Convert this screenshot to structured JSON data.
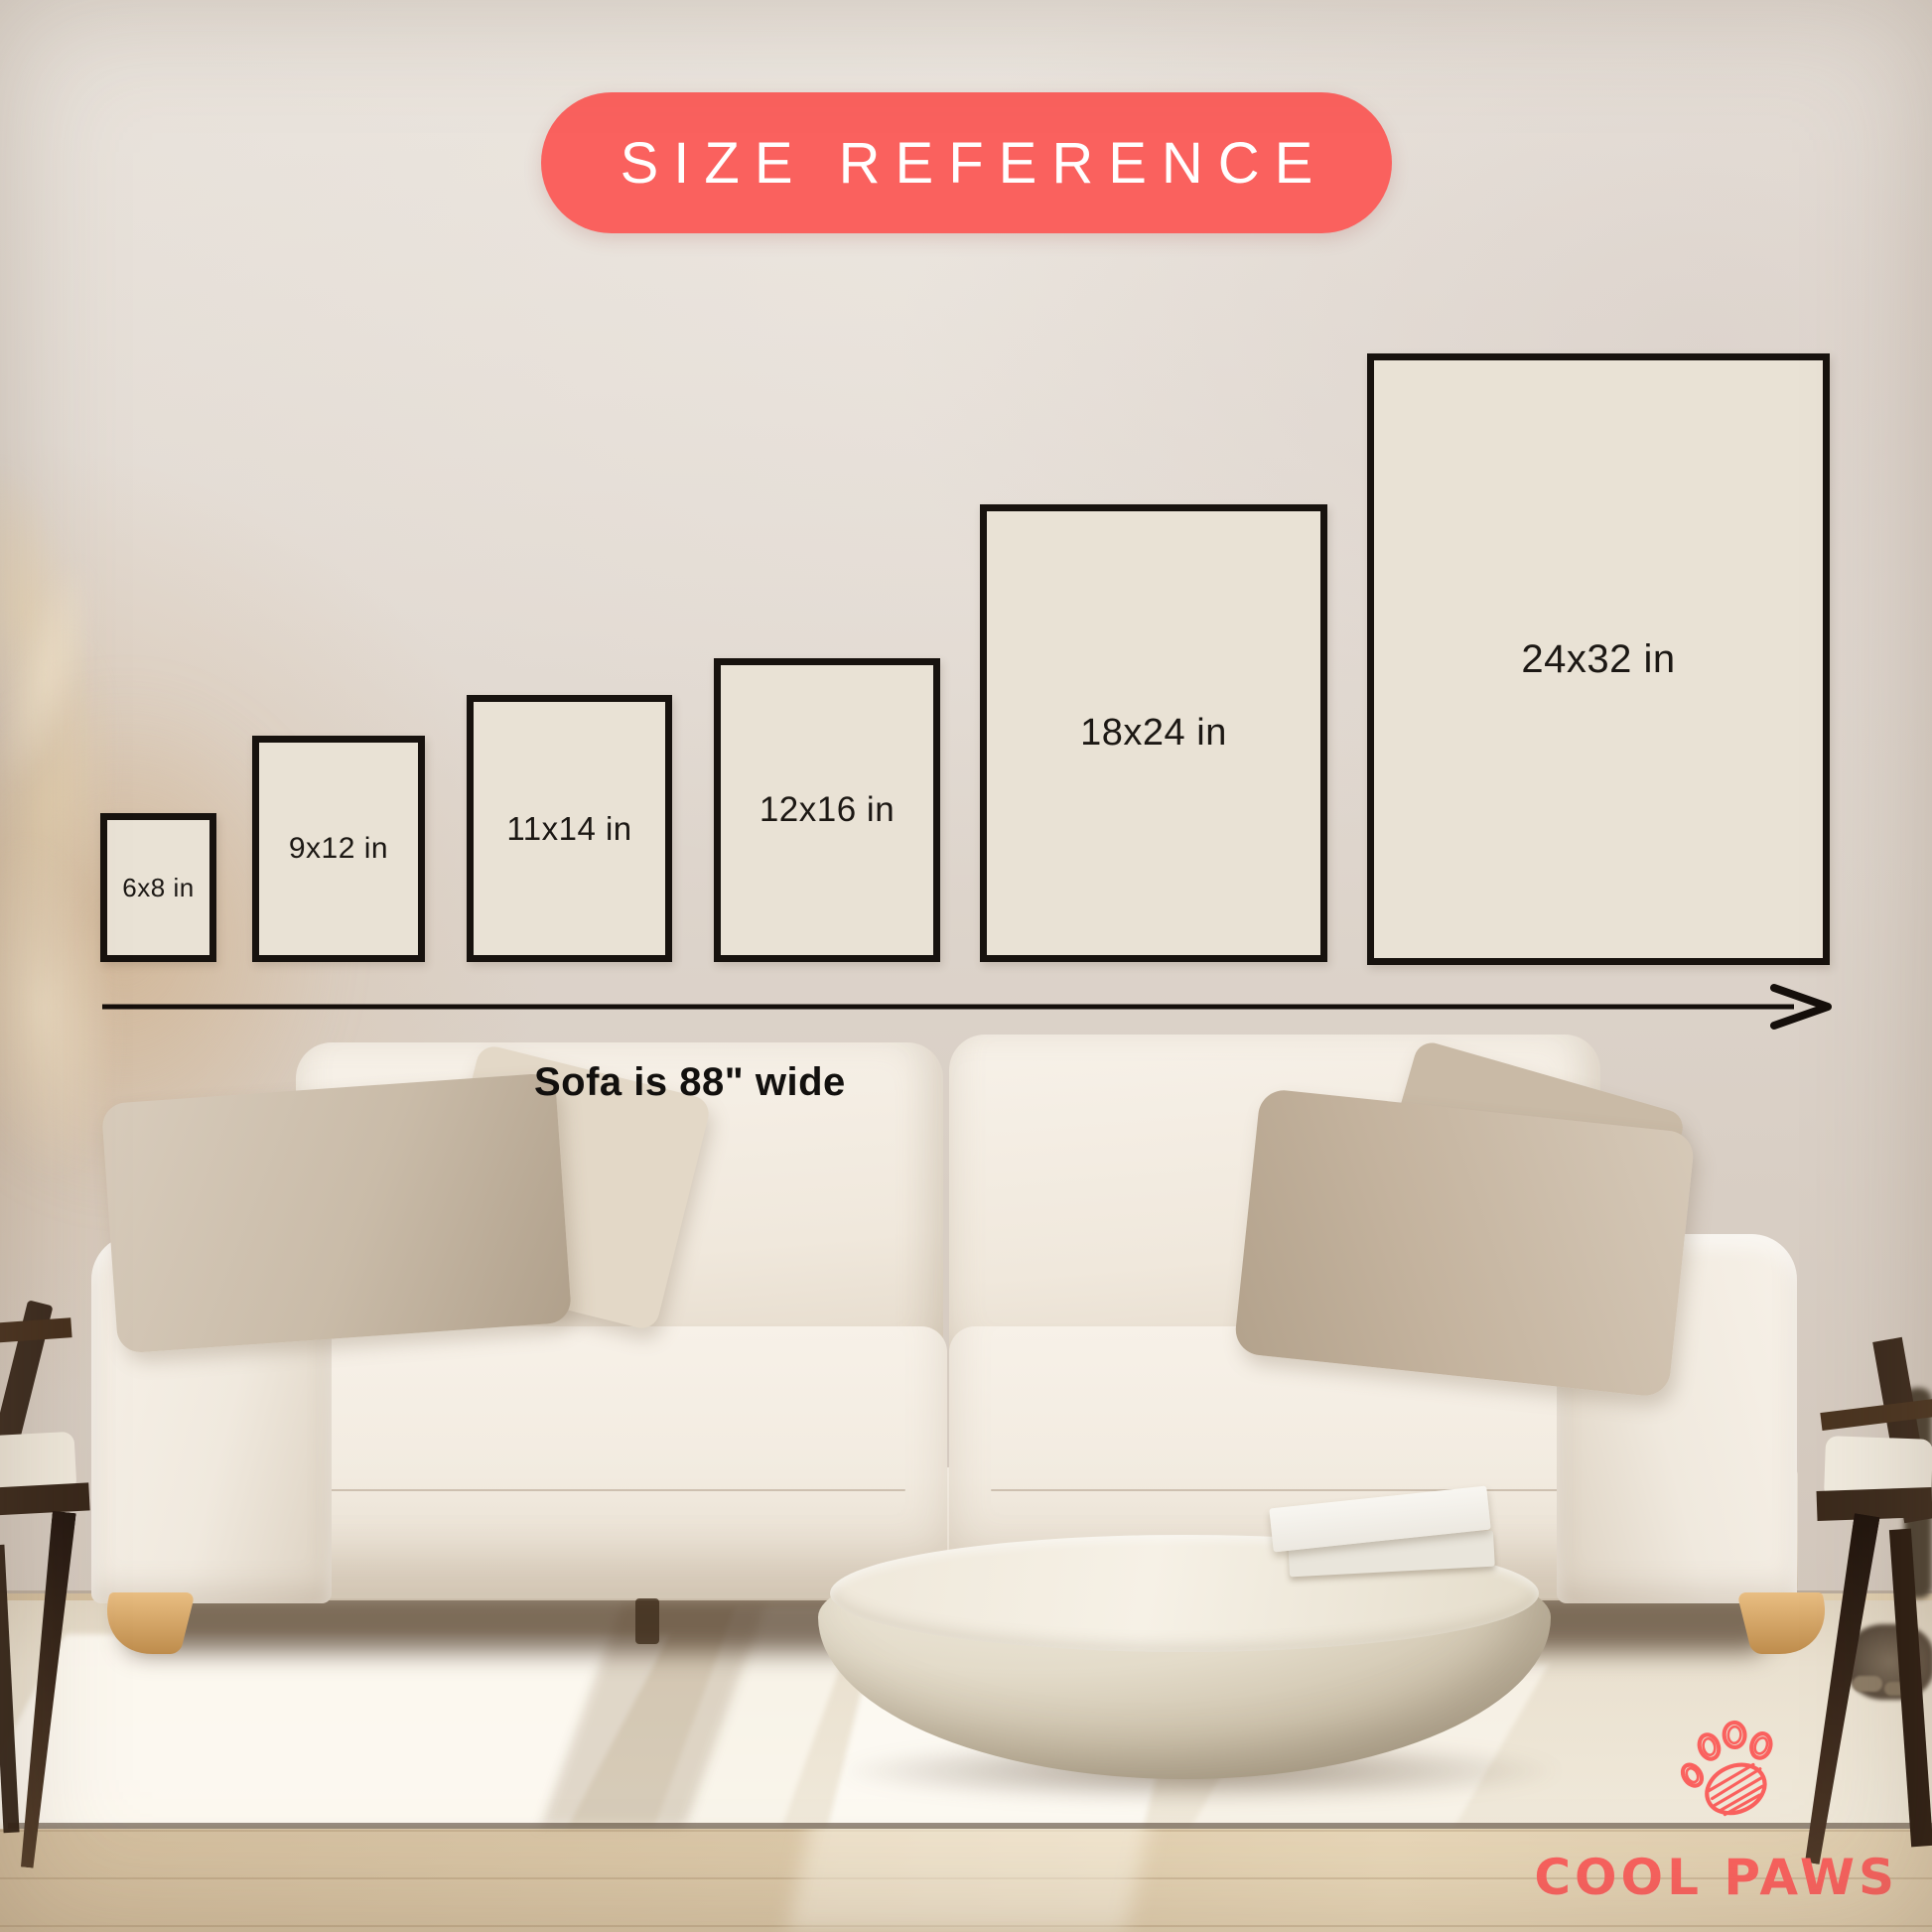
{
  "badge": {
    "label": "SIZE REFERENCE"
  },
  "sizes": [
    {
      "label": "6x8 in"
    },
    {
      "label": "9x12 in"
    },
    {
      "label": "11x14 in"
    },
    {
      "label": "12x16 in"
    },
    {
      "label": "18x24 in"
    },
    {
      "label": "24x32 in"
    }
  ],
  "sofa_note": "Sofa is 88\" wide",
  "brand": {
    "name": "COOL PAWS"
  },
  "colors": {
    "accent": "#FA615E",
    "frame_fill": "#E9E2D5",
    "frame_border": "#17120E",
    "label_text": "#1C1814",
    "badge_text": "#FFFFFF",
    "arrow": "#150F0B"
  }
}
